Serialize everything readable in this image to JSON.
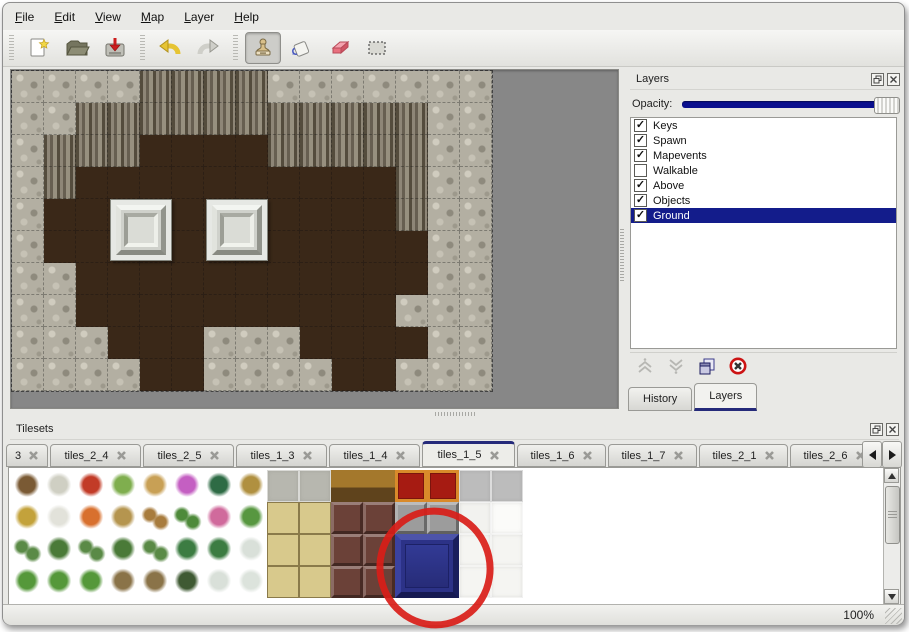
{
  "icons": {
    "close_glyph": "×",
    "check_glyph": "✓"
  },
  "menu": {
    "items": [
      {
        "id": "file",
        "label": "File"
      },
      {
        "id": "edit",
        "label": "Edit"
      },
      {
        "id": "view",
        "label": "View"
      },
      {
        "id": "map",
        "label": "Map"
      },
      {
        "id": "layer",
        "label": "Layer"
      },
      {
        "id": "help",
        "label": "Help"
      }
    ]
  },
  "toolbar": {
    "buttons": [
      {
        "id": "new-file",
        "group": 0,
        "pressed": false
      },
      {
        "id": "open-file",
        "group": 0,
        "pressed": false
      },
      {
        "id": "save-file",
        "group": 0,
        "pressed": false
      },
      {
        "id": "undo",
        "group": 1,
        "pressed": false
      },
      {
        "id": "redo",
        "group": 1,
        "pressed": false
      },
      {
        "id": "stamp-tool",
        "group": 2,
        "pressed": true
      },
      {
        "id": "fill-tool",
        "group": 2,
        "pressed": false
      },
      {
        "id": "eraser-tool",
        "group": 2,
        "pressed": false
      },
      {
        "id": "select-tool",
        "group": 2,
        "pressed": false
      }
    ]
  },
  "map": {
    "grid": [
      "GGGGCCCCGGGGGGG",
      "GGCCCCCCCCCCCGG",
      "GCCCBBBBCCCCCGG",
      "GCBBBBBBBBBBCGG",
      "GBBBBBBBBBBBCGG",
      "GBBBBBBBBBBBBGG",
      "GGBBBBBBBBBBBGG",
      "GGBBBBBBBBBBGGG",
      "GGGBBBGGGBBBBGG",
      "GGGGBBGGGGBBGGG"
    ],
    "pedestals": [
      {
        "col": 3,
        "row": 4
      },
      {
        "col": 6,
        "row": 4
      }
    ]
  },
  "layers_panel": {
    "title": "Layers",
    "opacity_label": "Opacity:",
    "opacity_percent": 100,
    "layers": [
      {
        "name": "Keys",
        "checked": true,
        "selected": false
      },
      {
        "name": "Spawn",
        "checked": true,
        "selected": false
      },
      {
        "name": "Mapevents",
        "checked": true,
        "selected": false
      },
      {
        "name": "Walkable",
        "checked": false,
        "selected": false
      },
      {
        "name": "Above",
        "checked": true,
        "selected": false
      },
      {
        "name": "Objects",
        "checked": true,
        "selected": false
      },
      {
        "name": "Ground",
        "checked": true,
        "selected": true
      }
    ],
    "actions": [
      {
        "id": "raise-layer",
        "disabled": true
      },
      {
        "id": "lower-layer",
        "disabled": true
      },
      {
        "id": "duplicate-layer",
        "disabled": false
      },
      {
        "id": "delete-layer",
        "disabled": false
      }
    ],
    "tabs": [
      {
        "label": "History",
        "active": false
      },
      {
        "label": "Layers",
        "active": true
      }
    ]
  },
  "tilesets": {
    "title": "Tilesets",
    "tabs": [
      {
        "label": "3",
        "active": false,
        "width": 42
      },
      {
        "label": "tiles_2_4",
        "active": false,
        "width": 91
      },
      {
        "label": "tiles_2_5",
        "active": false,
        "width": 91
      },
      {
        "label": "tiles_1_3",
        "active": false,
        "width": 91
      },
      {
        "label": "tiles_1_4",
        "active": false,
        "width": 91
      },
      {
        "label": "tiles_1_5",
        "active": true,
        "width": 93
      },
      {
        "label": "tiles_1_6",
        "active": false,
        "width": 89
      },
      {
        "label": "tiles_1_7",
        "active": false,
        "width": 89
      },
      {
        "label": "tiles_2_1",
        "active": false,
        "width": 89
      },
      {
        "label": "tiles_2_6",
        "active": false,
        "width": 89
      }
    ],
    "grid": [
      [
        "t1",
        "t2",
        "f1",
        "s1",
        "k1",
        "f2",
        "p1",
        "w1",
        "ST",
        "ST",
        "TA",
        "TA",
        "CR",
        "CR",
        "SI",
        "SI"
      ],
      [
        "h1",
        "h2",
        "f3",
        "g1",
        "l1",
        "y1",
        "f4",
        "y2",
        "TT",
        "TT",
        "MA",
        "MA",
        "BL",
        "BL",
        "WF",
        "WH"
      ],
      [
        "sp",
        "bu",
        "sp",
        "bu",
        "sp",
        "pm",
        "pm",
        "st",
        "TT",
        "TT",
        "MA",
        "MA",
        "..",
        "..",
        "WC",
        "WC"
      ],
      [
        "cn",
        "cn",
        "cn",
        "dt",
        "dt",
        "dg",
        "st",
        "sn",
        "TT",
        "TT",
        "MA",
        "MA",
        "..",
        "..",
        "WC",
        "WC"
      ]
    ],
    "tile_colors": {
      "t1": {
        "kind": "blob",
        "a": "#7a5a34",
        "b": "#ffffff"
      },
      "t2": {
        "kind": "blob",
        "a": "#cfcfc3",
        "b": "#ffffff"
      },
      "f1": {
        "kind": "blob",
        "a": "#c23b27",
        "b": "#ffffff"
      },
      "s1": {
        "kind": "blob",
        "a": "#7fae4e",
        "b": "#ffffff"
      },
      "k1": {
        "kind": "blob",
        "a": "#c8a055",
        "b": "#ffffff"
      },
      "f2": {
        "kind": "blob",
        "a": "#c45fc2",
        "b": "#ffffff"
      },
      "p1": {
        "kind": "blob",
        "a": "#2e6b45",
        "b": "#ffffff"
      },
      "w1": {
        "kind": "blob",
        "a": "#b09040",
        "b": "#ffffff"
      },
      "h1": {
        "kind": "blob",
        "a": "#c3a23b",
        "b": "#ffffff"
      },
      "h2": {
        "kind": "blob",
        "a": "#e2e2da",
        "b": "#ffffff"
      },
      "f3": {
        "kind": "blob",
        "a": "#d8702e",
        "b": "#ffffff"
      },
      "g1": {
        "kind": "blob",
        "a": "#b5954f",
        "b": "#ffffff"
      },
      "l1": {
        "kind": "blob2",
        "a": "#a87c3e",
        "b": "#ffffff"
      },
      "y1": {
        "kind": "blob2",
        "a": "#4e8a3a",
        "b": "#ffffff"
      },
      "f4": {
        "kind": "blob",
        "a": "#d06a9c",
        "b": "#ffffff"
      },
      "y2": {
        "kind": "blob",
        "a": "#579740",
        "b": "#ffffff"
      },
      "sp": {
        "kind": "blob2",
        "a": "#5a8a46",
        "b": "#ffffff"
      },
      "bu": {
        "kind": "blob",
        "a": "#4a7a38",
        "b": "#ffffff"
      },
      "pm": {
        "kind": "blob",
        "a": "#3c7c42",
        "b": "#ffffff"
      },
      "st": {
        "kind": "blob",
        "a": "#d9e0d9",
        "b": "#ffffff"
      },
      "cn": {
        "kind": "blob",
        "a": "#55983a",
        "b": "#ffffff"
      },
      "dt": {
        "kind": "blob",
        "a": "#8a7348",
        "b": "#ffffff"
      },
      "dg": {
        "kind": "blob",
        "a": "#3f5a33",
        "b": "#ffffff"
      },
      "sn": {
        "kind": "blob",
        "a": "#dce3dc",
        "b": "#ffffff"
      },
      "ST": {
        "kind": "flat",
        "a": "#8f8f87",
        "b": "#b7b7af"
      },
      "TA": {
        "kind": "split",
        "a": "#5f431c",
        "b": "#a4782c"
      },
      "CR": {
        "kind": "carpet",
        "a": "#d98a2a",
        "b": "#a61b12"
      },
      "SI": {
        "kind": "flat",
        "a": "#e8e8e8",
        "b": "#bcbcbc"
      },
      "TT": {
        "kind": "mat",
        "a": "#8a7a4a",
        "b": "#d8c98c"
      },
      "MA": {
        "kind": "bevel",
        "a": "#4a2c26",
        "b": "#6b4138"
      },
      "BL": {
        "kind": "bevel",
        "a": "#707070",
        "b": "#9c9c9c"
      },
      "WF": {
        "kind": "flat",
        "a": "#d8d8d4",
        "b": "#f2f2ef"
      },
      "WH": {
        "kind": "flat",
        "a": "#e8e8e8",
        "b": "#fbfbf9"
      },
      "WC": {
        "kind": "flat",
        "a": "#dddDda",
        "b": "#f5f5f2"
      },
      "..": {
        "kind": "flat",
        "a": "#ffffff",
        "b": "#ffffff"
      }
    },
    "selected_tile": {
      "col": 12,
      "row": 2,
      "span": 2,
      "color": "#2c3287"
    },
    "annotation": {
      "shape": "ellipse",
      "color": "#d91d18",
      "stroke_width": 7
    }
  },
  "status": {
    "zoom_level": "100%"
  }
}
